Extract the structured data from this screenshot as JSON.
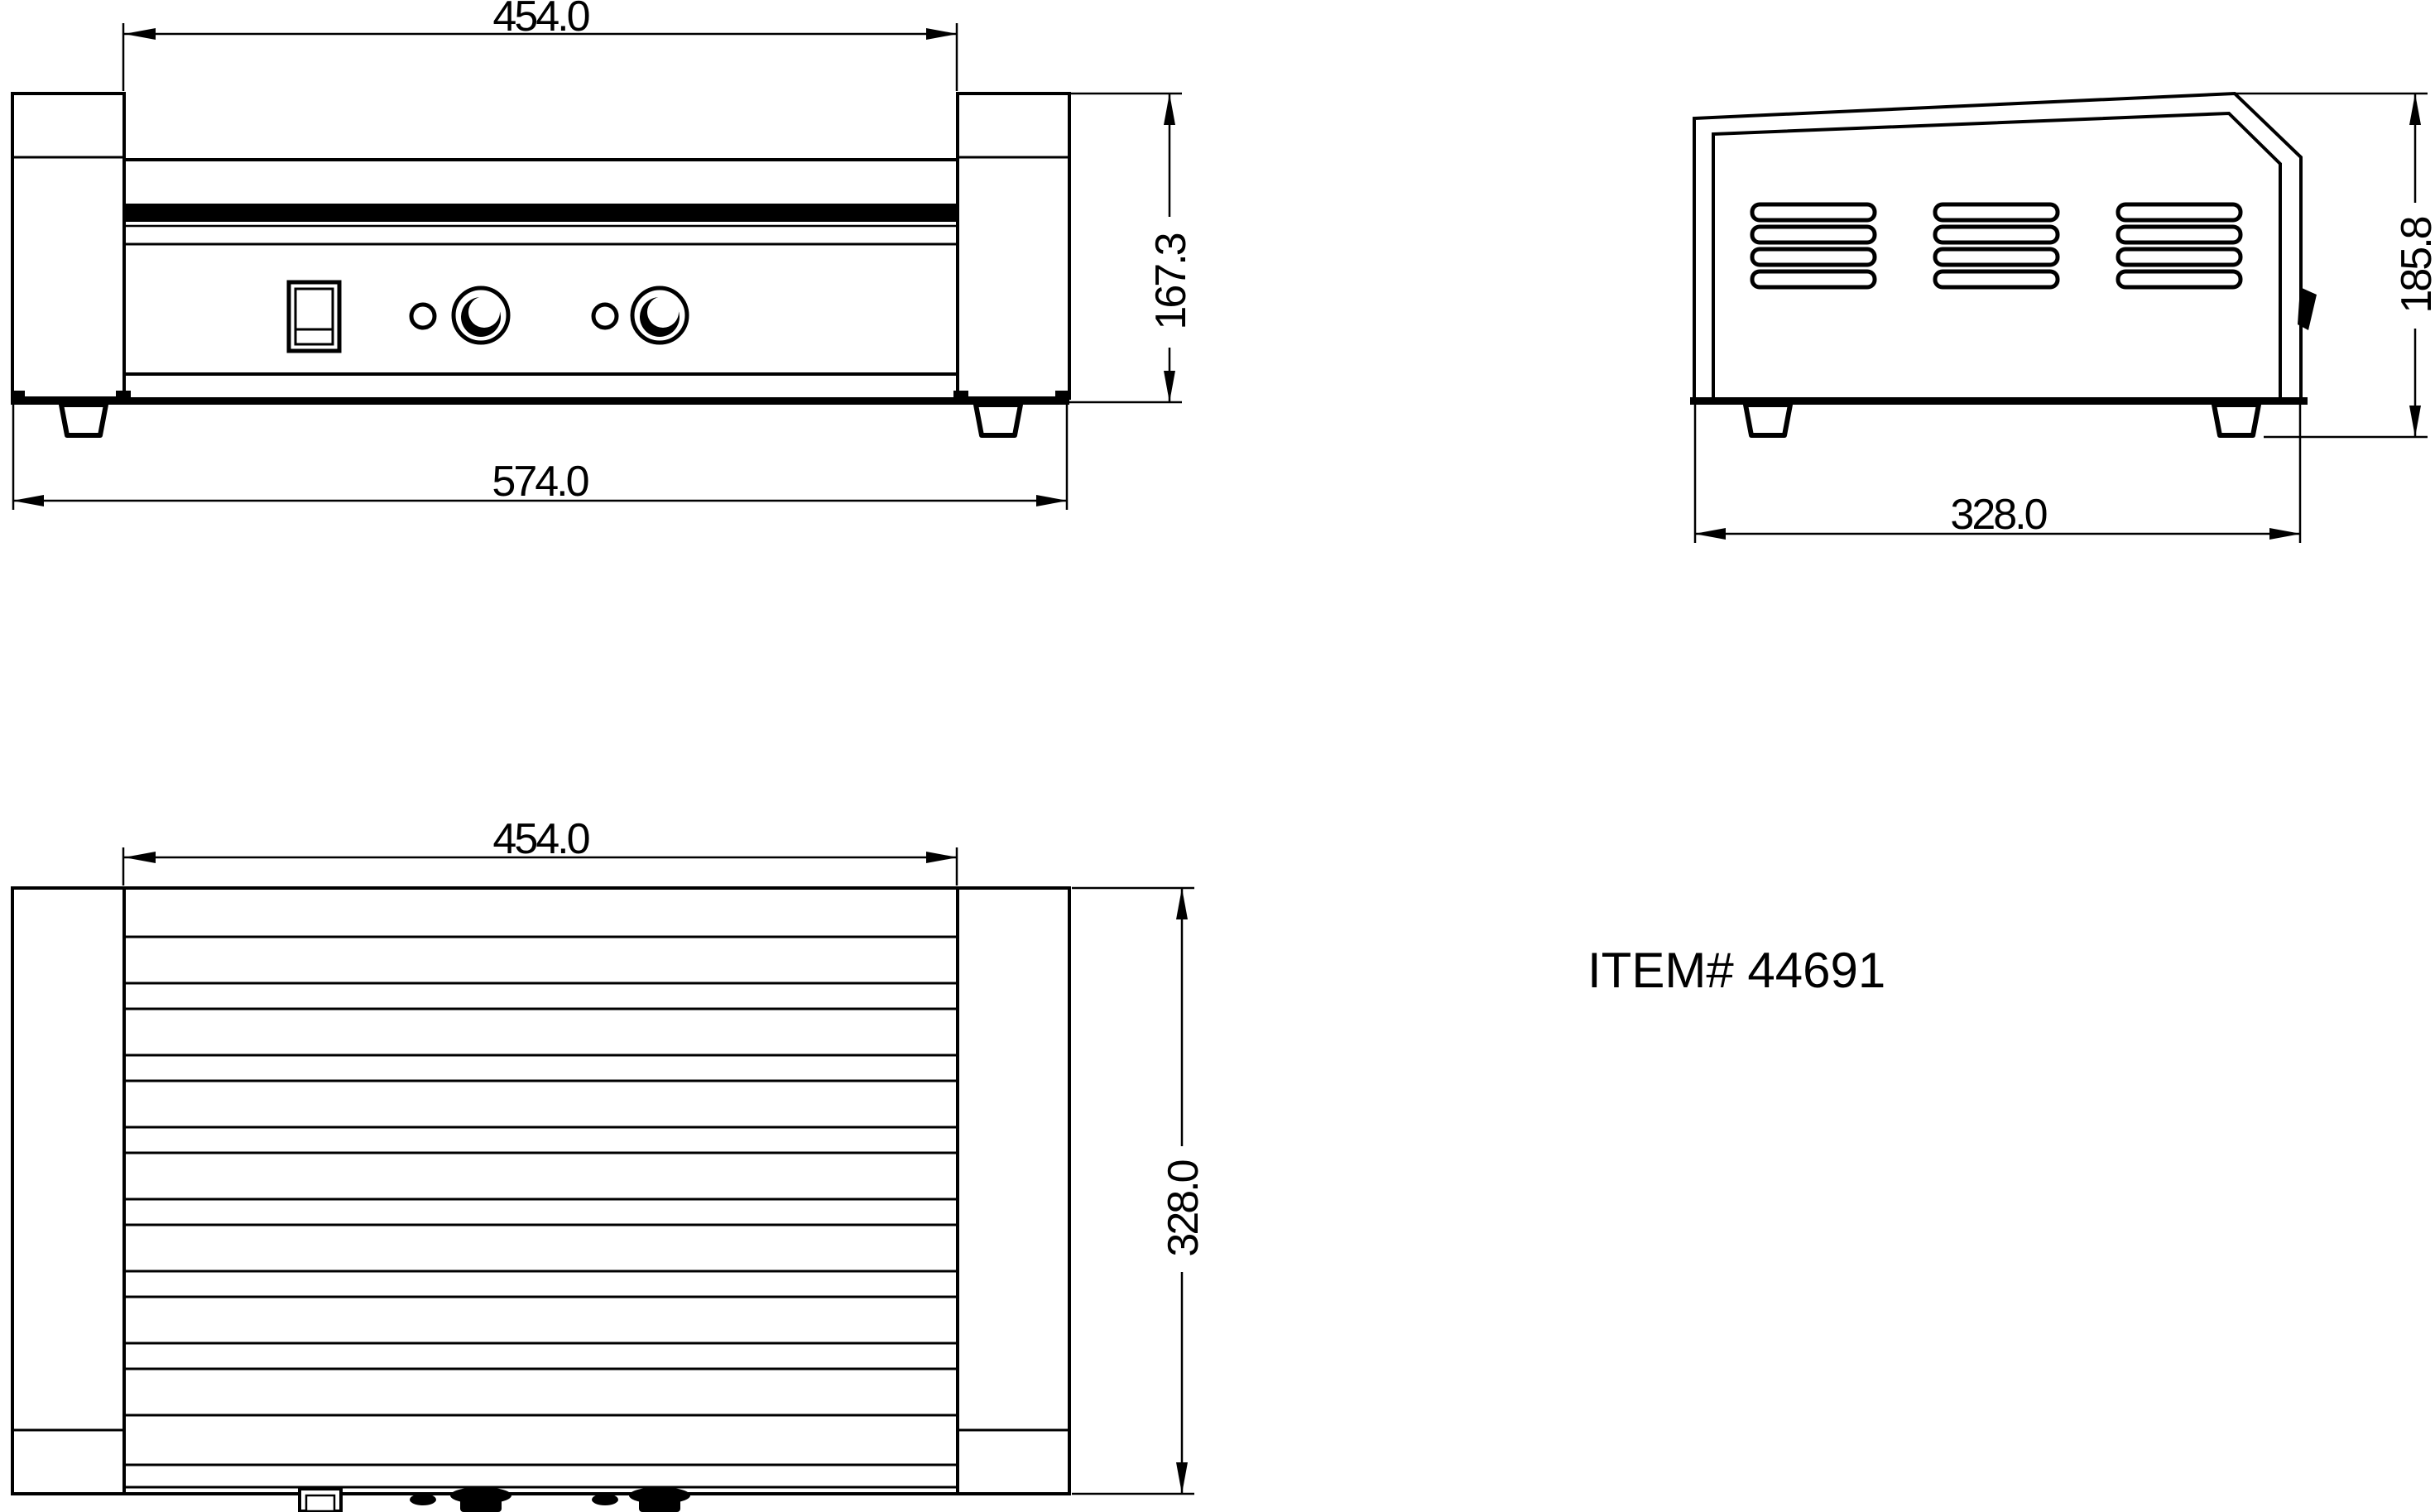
{
  "page": {
    "background": "#ffffff",
    "ink": "#000000"
  },
  "item": {
    "label": "ITEM# 44691"
  },
  "views": {
    "front": {
      "dim_roller_width": "454.0",
      "dim_overall_width": "574.0",
      "dim_height": "167.3"
    },
    "side": {
      "dim_depth": "328.0",
      "dim_height": "185.8"
    },
    "top": {
      "dim_roller_width": "454.0",
      "dim_depth": "328.0"
    }
  }
}
